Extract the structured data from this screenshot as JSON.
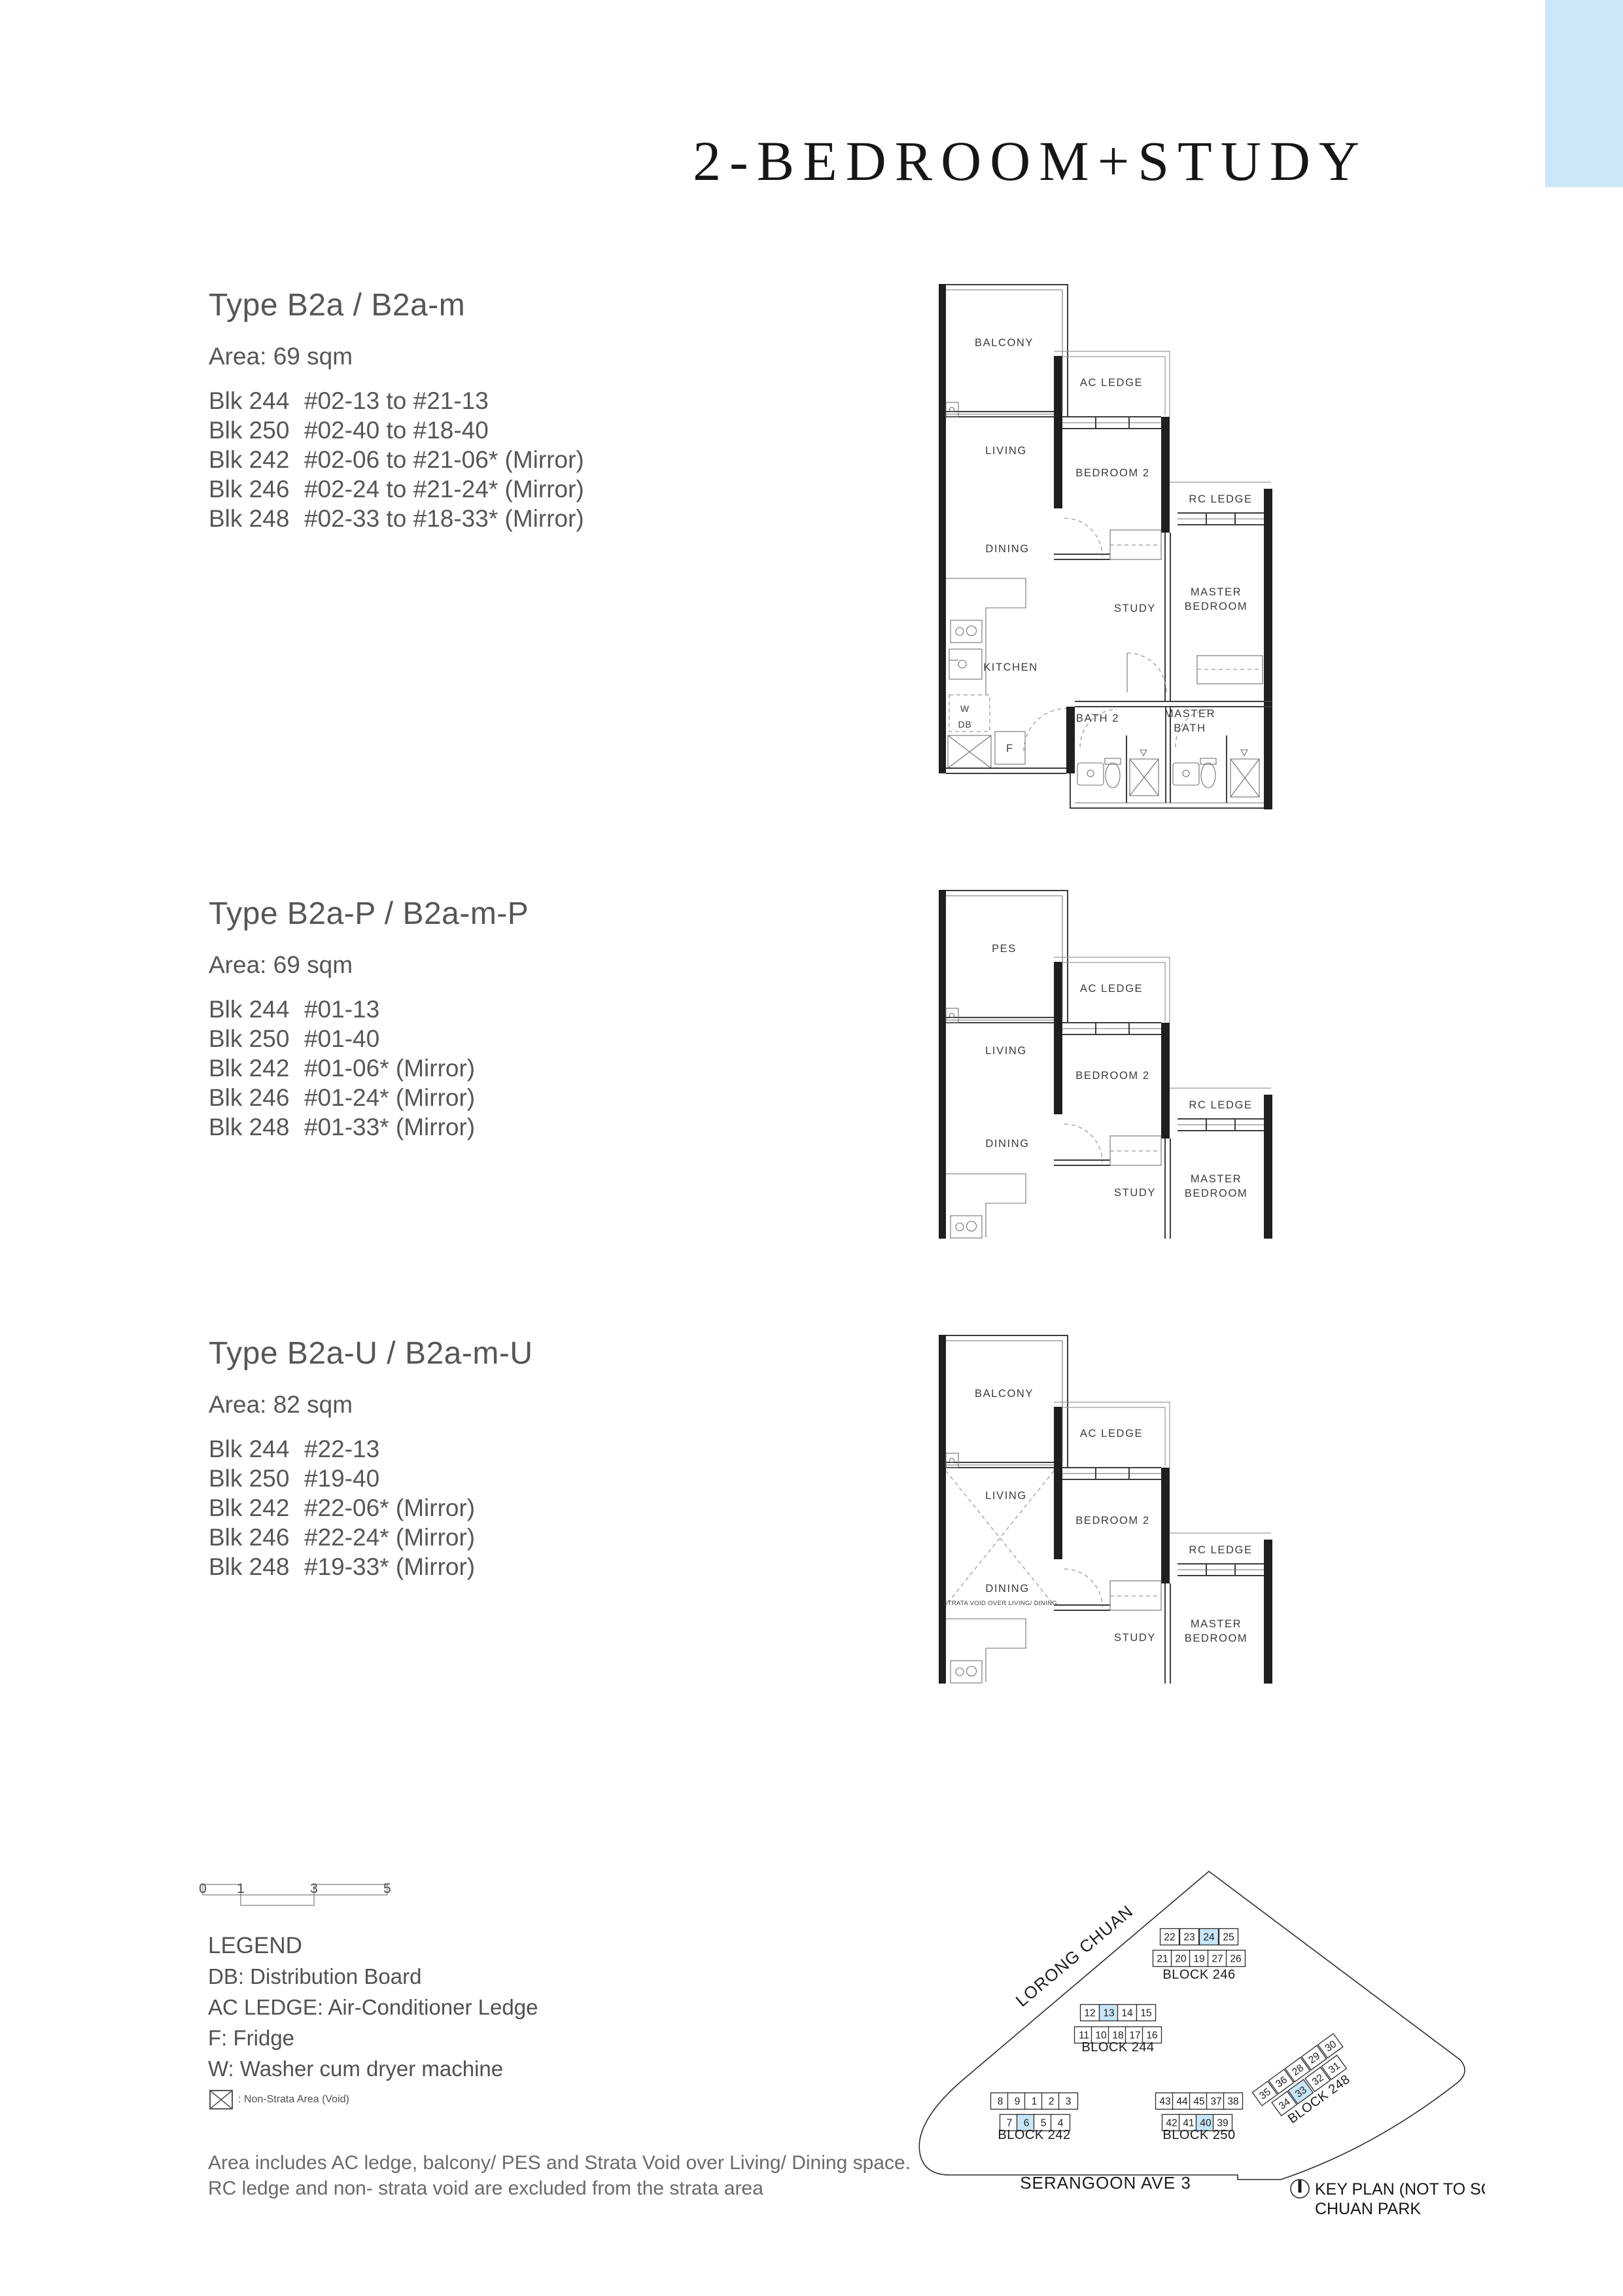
{
  "page": {
    "title": "2-BEDROOM+STUDY"
  },
  "colors": {
    "highlight_blue": "#c7e6f7",
    "corner_blue": "#cbe7f8"
  },
  "sections": [
    {
      "type_title": "Type B2a / B2a-m",
      "area_label": "Area: 69 sqm",
      "units": [
        {
          "blk": "Blk 244",
          "range": "#02-13 to #21-13"
        },
        {
          "blk": "Blk 250",
          "range": "#02-40 to #18-40"
        },
        {
          "blk": "Blk 242",
          "range": "#02-06 to #21-06* (Mirror)"
        },
        {
          "blk": "Blk 246",
          "range": "#02-24 to #21-24* (Mirror)"
        },
        {
          "blk": "Blk 248",
          "range": "#02-33 to #18-33* (Mirror)"
        }
      ]
    },
    {
      "type_title": "Type B2a-P / B2a-m-P",
      "area_label": "Area: 69 sqm",
      "units": [
        {
          "blk": "Blk 244",
          "range": "#01-13"
        },
        {
          "blk": "Blk 250",
          "range": "#01-40"
        },
        {
          "blk": "Blk 242",
          "range": "#01-06* (Mirror)"
        },
        {
          "blk": "Blk 246",
          "range": "#01-24* (Mirror)"
        },
        {
          "blk": "Blk 248",
          "range": "#01-33* (Mirror)"
        }
      ]
    },
    {
      "type_title": "Type B2a-U / B2a-m-U",
      "area_label": "Area: 82 sqm",
      "units": [
        {
          "blk": "Blk 244",
          "range": "#22-13"
        },
        {
          "blk": "Blk 250",
          "range": "#19-40"
        },
        {
          "blk": "Blk 242",
          "range": "#22-06* (Mirror)"
        },
        {
          "blk": "Blk 246",
          "range": "#22-24* (Mirror)"
        },
        {
          "blk": "Blk 248",
          "range": "#19-33* (Mirror)"
        }
      ]
    }
  ],
  "floorplan_labels": {
    "balcony": "BALCONY",
    "pes": "PES",
    "ac_ledge": "AC LEDGE",
    "rc_ledge": "RC LEDGE",
    "living": "LIVING",
    "dining": "DINING",
    "bedroom2": "BEDROOM 2",
    "master_line1": "MASTER",
    "master_line2": "BEDROOM",
    "study": "STUDY",
    "kitchen": "KITCHEN",
    "bath2": "BATH 2",
    "master_bath_line1": "MASTER",
    "master_bath_line2": "BATH",
    "washer": "W",
    "db": "DB",
    "fridge": "F",
    "strata_void": "STRATA VOID OVER LIVING/ DINING"
  },
  "scalebar": {
    "ticks": [
      "0",
      "1",
      "3",
      "5"
    ]
  },
  "legend": {
    "title": "LEGEND",
    "entries": [
      "DB: Distribution Board",
      "AC LEDGE: Air-Conditioner Ledge",
      "F: Fridge",
      "W: Washer cum dryer machine"
    ],
    "void_entry": ": Non-Strata Area (Void)"
  },
  "footnote": {
    "line1": "Area includes AC ledge, balcony/ PES and Strata Void over Living/ Dining space.",
    "line2": "RC ledge and non- strata void are excluded from the strata area"
  },
  "keyplan": {
    "road_left": "LORONG CHUAN",
    "road_bottom": "SERANGOON AVE 3",
    "title": "KEY PLAN (NOT TO SCALE)",
    "subtitle": "CHUAN PARK",
    "blocks": [
      {
        "name": "BLOCK 246",
        "row_top": [
          "22",
          "23",
          "24",
          "25"
        ],
        "row_bottom": [
          "21",
          "20",
          "19",
          "27",
          "26"
        ],
        "highlight": "24"
      },
      {
        "name": "BLOCK 244",
        "row_top": [
          "12",
          "13",
          "14",
          "15"
        ],
        "row_bottom": [
          "11",
          "10",
          "18",
          "17",
          "16"
        ],
        "highlight": "13"
      },
      {
        "name": "BLOCK 242",
        "row_top": [
          "8",
          "9",
          "1",
          "2",
          "3"
        ],
        "row_bottom": [
          "7",
          "6",
          "5",
          "4"
        ],
        "highlight": "6"
      },
      {
        "name": "BLOCK 250",
        "row_top": [
          "43",
          "44",
          "45",
          "37",
          "38"
        ],
        "row_bottom": [
          "42",
          "41",
          "40",
          "39"
        ],
        "highlight": "40"
      },
      {
        "name": "BLOCK 248",
        "row_top": [
          "35",
          "36",
          "28",
          "29",
          "30"
        ],
        "row_bottom": [
          "34",
          "33",
          "32",
          "31"
        ],
        "highlight": "33"
      }
    ]
  }
}
